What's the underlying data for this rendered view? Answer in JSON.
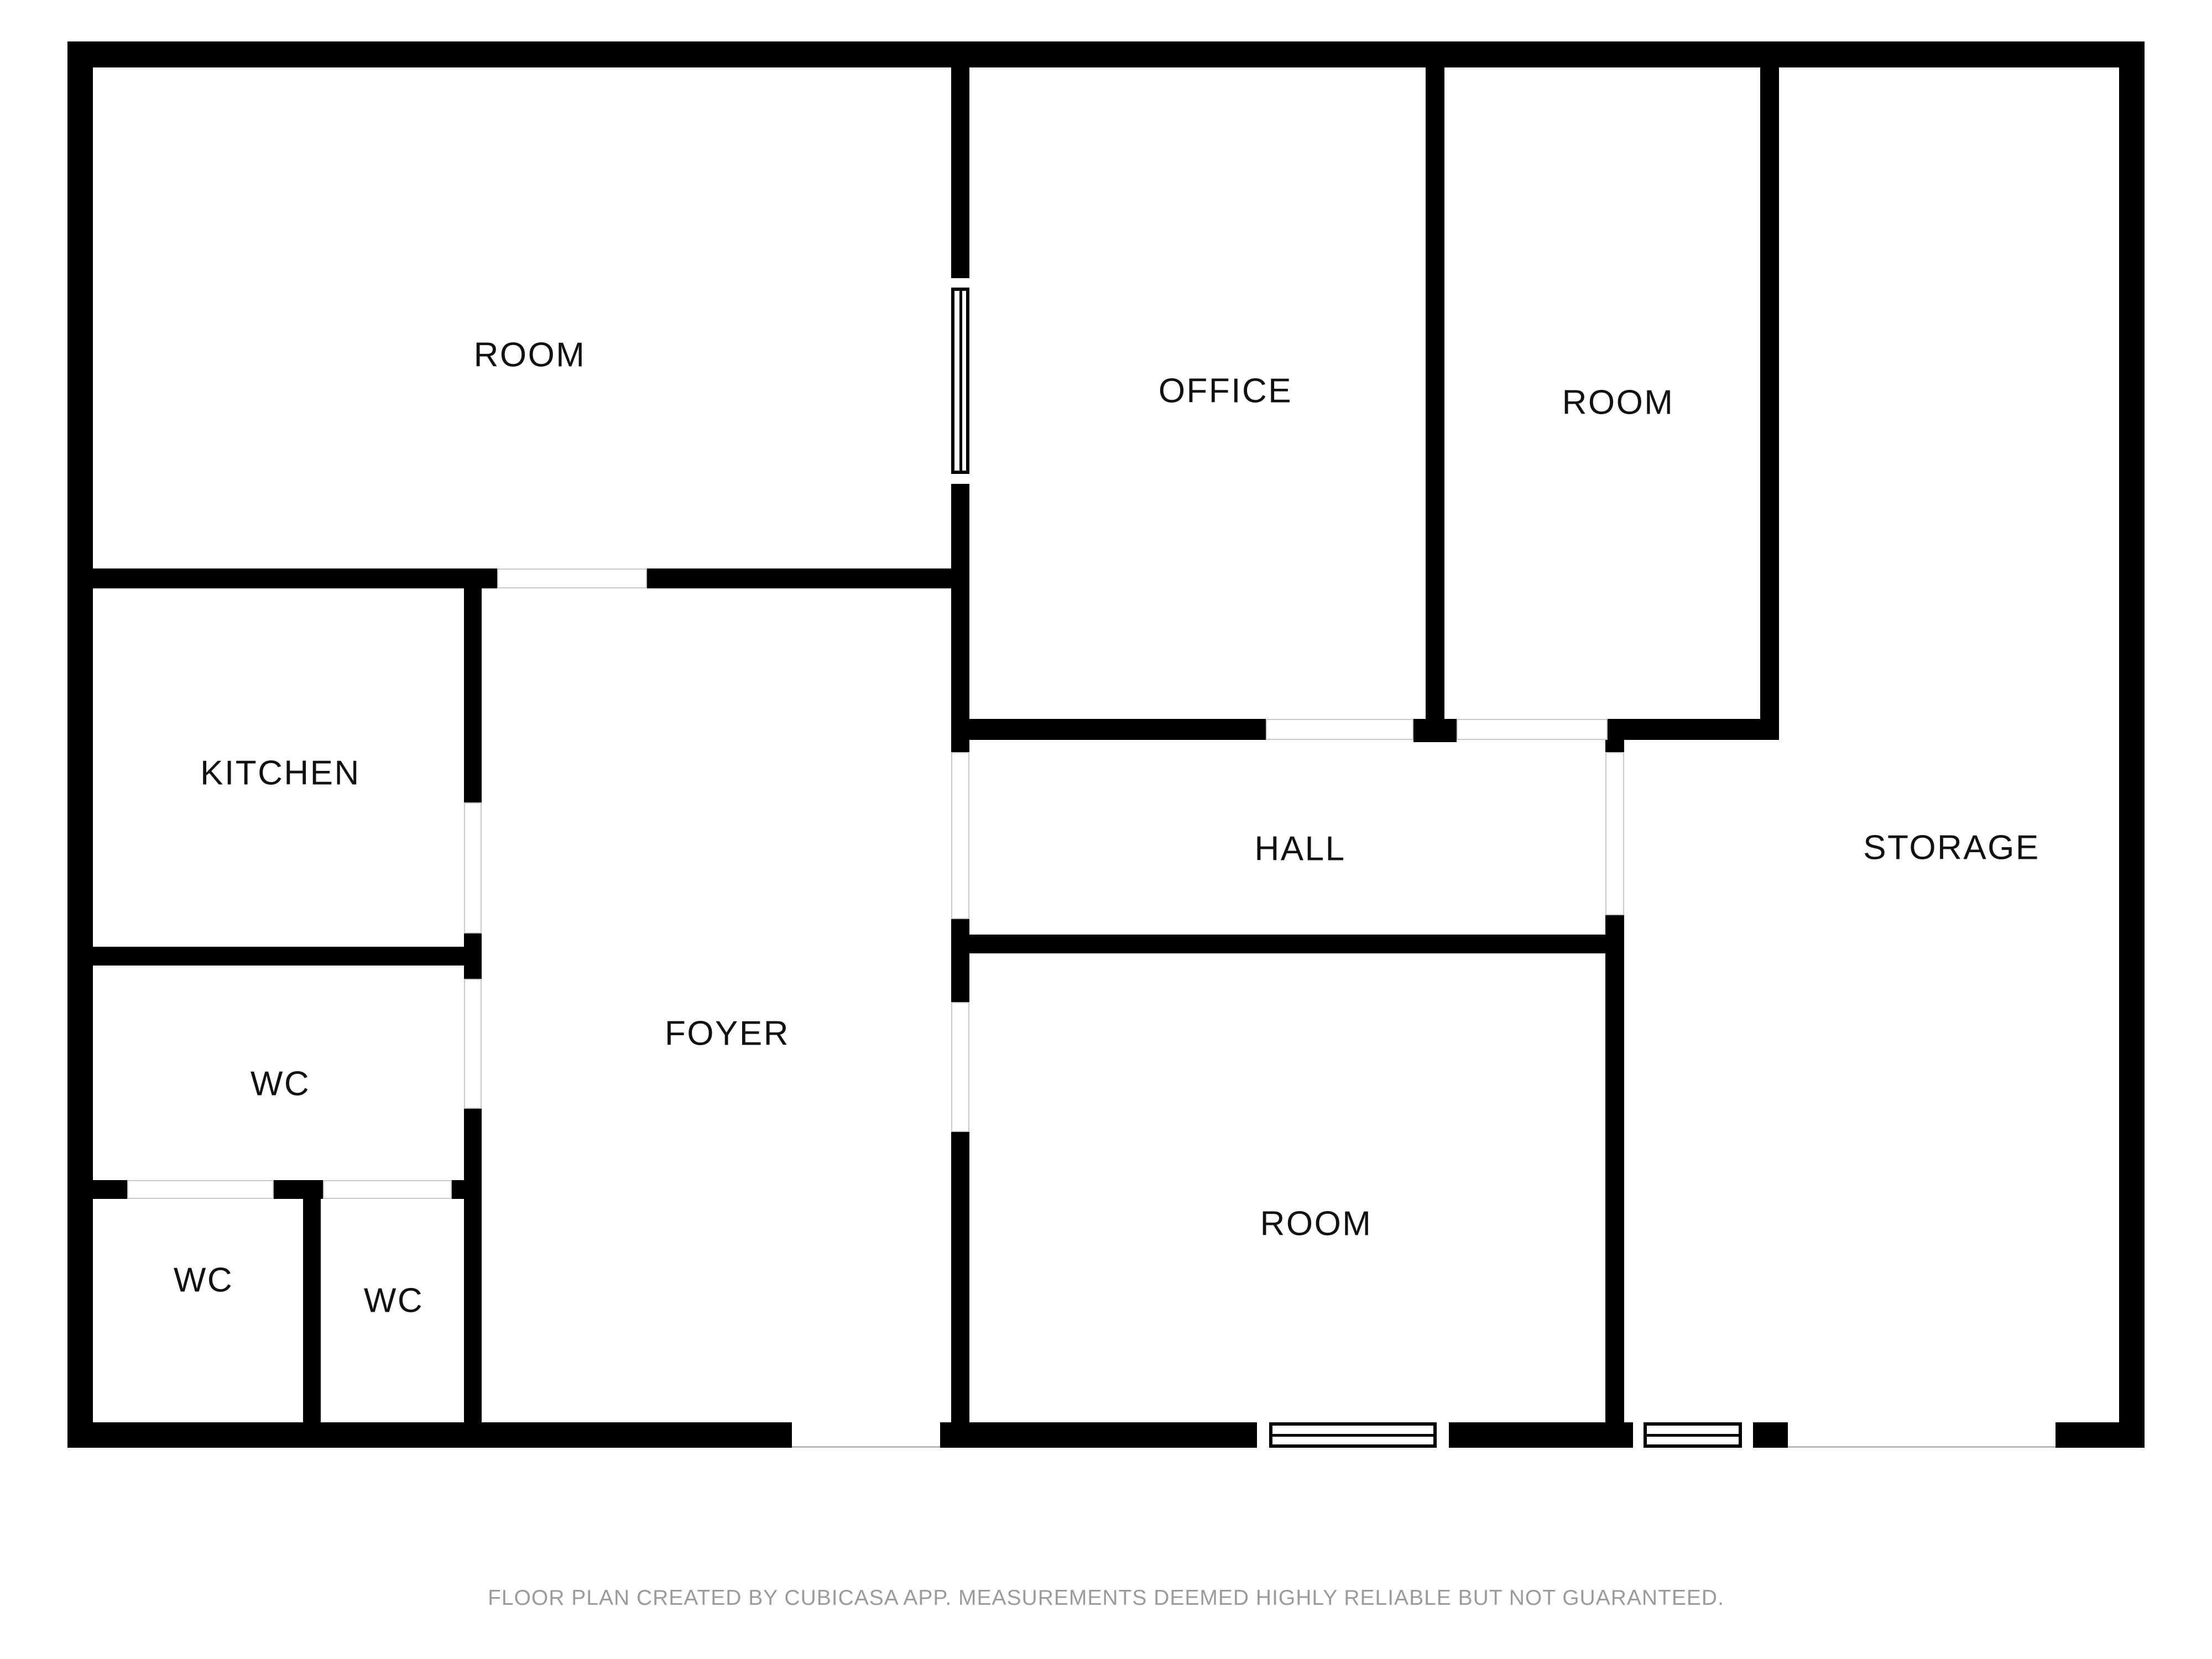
{
  "title": "Floor plan",
  "rooms": [
    {
      "id": "room-top-left",
      "label": "ROOM"
    },
    {
      "id": "office",
      "label": "OFFICE"
    },
    {
      "id": "room-top-right",
      "label": "ROOM"
    },
    {
      "id": "kitchen",
      "label": "KITCHEN"
    },
    {
      "id": "hall",
      "label": "HALL"
    },
    {
      "id": "storage",
      "label": "STORAGE"
    },
    {
      "id": "foyer",
      "label": "FOYER"
    },
    {
      "id": "wc-middle",
      "label": "WC"
    },
    {
      "id": "wc-bottom-left",
      "label": "WC"
    },
    {
      "id": "wc-bottom-center",
      "label": "WC"
    },
    {
      "id": "room-bottom",
      "label": "ROOM"
    }
  ],
  "footer": {
    "text": "FLOOR PLAN CREATED BY CUBICASA APP. MEASUREMENTS DEEMED HIGHLY RELIABLE BUT NOT GUARANTEED."
  },
  "colors": {
    "wall": "#000000",
    "background": "#ffffff",
    "door_outline": "#c8c8c8",
    "label_text": "#111111",
    "footer_text": "#9b9b9b"
  }
}
